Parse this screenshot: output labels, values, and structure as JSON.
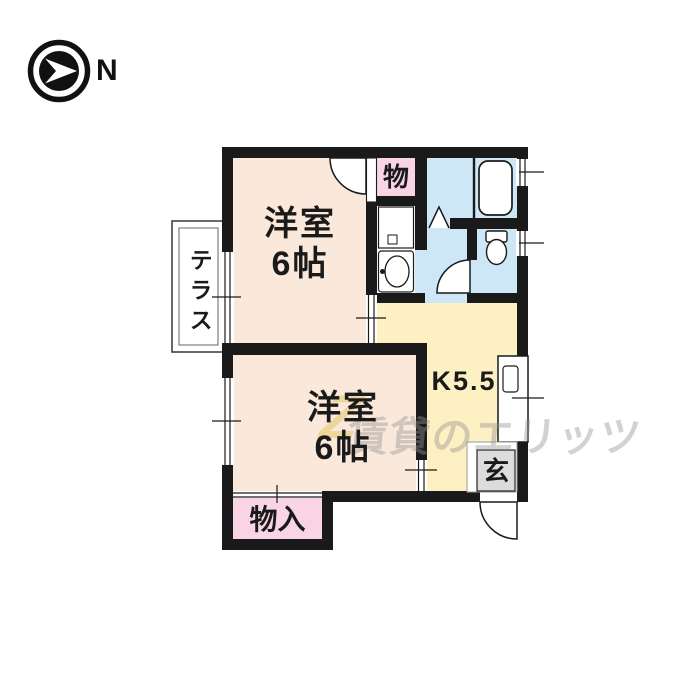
{
  "compass": {
    "label": "N"
  },
  "colors": {
    "wall": "#1a1a1a",
    "room": "#fae8da",
    "kitchen": "#fdf0c3",
    "wet": "#cde7f6",
    "storage_pink": "#f8d4e4",
    "genkan_gray": "#dcdcdc",
    "white": "#ffffff"
  },
  "rooms": {
    "room1": {
      "name": "洋室",
      "size": "6帖"
    },
    "room2": {
      "name": "洋室",
      "size": "6帖"
    },
    "kitchen": {
      "label": "K5.5"
    },
    "storage_top": {
      "label": "物"
    },
    "storage_bottom": {
      "label": "物入"
    },
    "terrace": {
      "label": "テラス"
    },
    "entrance": {
      "label": "玄"
    }
  },
  "watermark": {
    "logo": "Z",
    "text": "賃貸のエリッツ"
  }
}
